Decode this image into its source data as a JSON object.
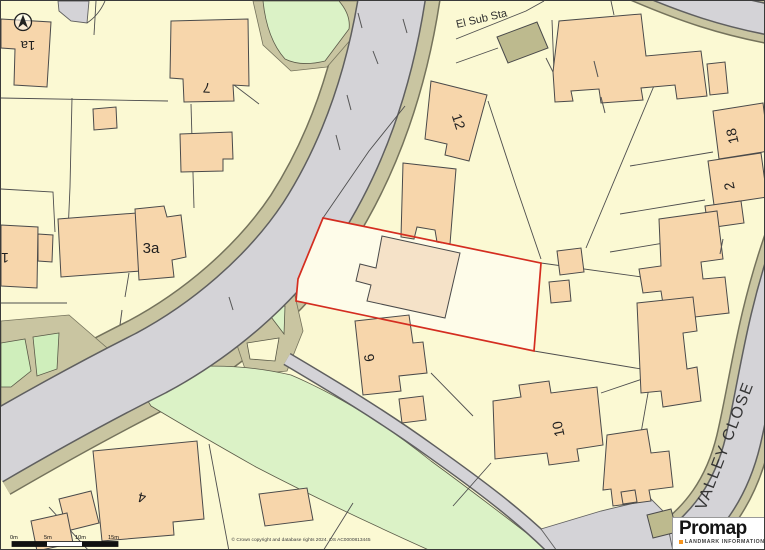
{
  "map": {
    "plot_labels": [
      {
        "id": "1a",
        "text": "1a"
      },
      {
        "id": "7",
        "text": "7"
      },
      {
        "id": "1",
        "text": "1"
      },
      {
        "id": "3a",
        "text": "3a"
      },
      {
        "id": "12",
        "text": "12"
      },
      {
        "id": "18",
        "text": "18"
      },
      {
        "id": "2",
        "text": "2"
      },
      {
        "id": "6",
        "text": "6"
      },
      {
        "id": "10",
        "text": "10"
      },
      {
        "id": "4",
        "text": "4"
      }
    ],
    "poi_labels": [
      {
        "id": "el-sub-sta",
        "text": "El Sub Sta"
      }
    ],
    "street_labels": [
      {
        "id": "valley-close",
        "text": "VALLEY CLOSE"
      }
    ],
    "colors": {
      "background": "#fbf9d3",
      "building": "#f7d6ab",
      "building_washed": "#f5e2c8",
      "utility_building": "#bdba8e",
      "road_surface": "#d4d3d7",
      "road_verge": "#c9c5a1",
      "vegetation": "#dbf2c6",
      "boundary_line": "#4e4e4e",
      "selection_outline": "#d42d20",
      "selection_fill": "#fefce9"
    }
  },
  "scalebar": {
    "labels": [
      "0m",
      "5m",
      "10m",
      "15m"
    ]
  },
  "attribution": {
    "text": "© Crown copyright and database rights 2024. OS AC0000813445"
  },
  "branding": {
    "logo_text": "Promap",
    "tagline": "LANDMARK INFORMATION",
    "accent_color": "#f7941d"
  }
}
